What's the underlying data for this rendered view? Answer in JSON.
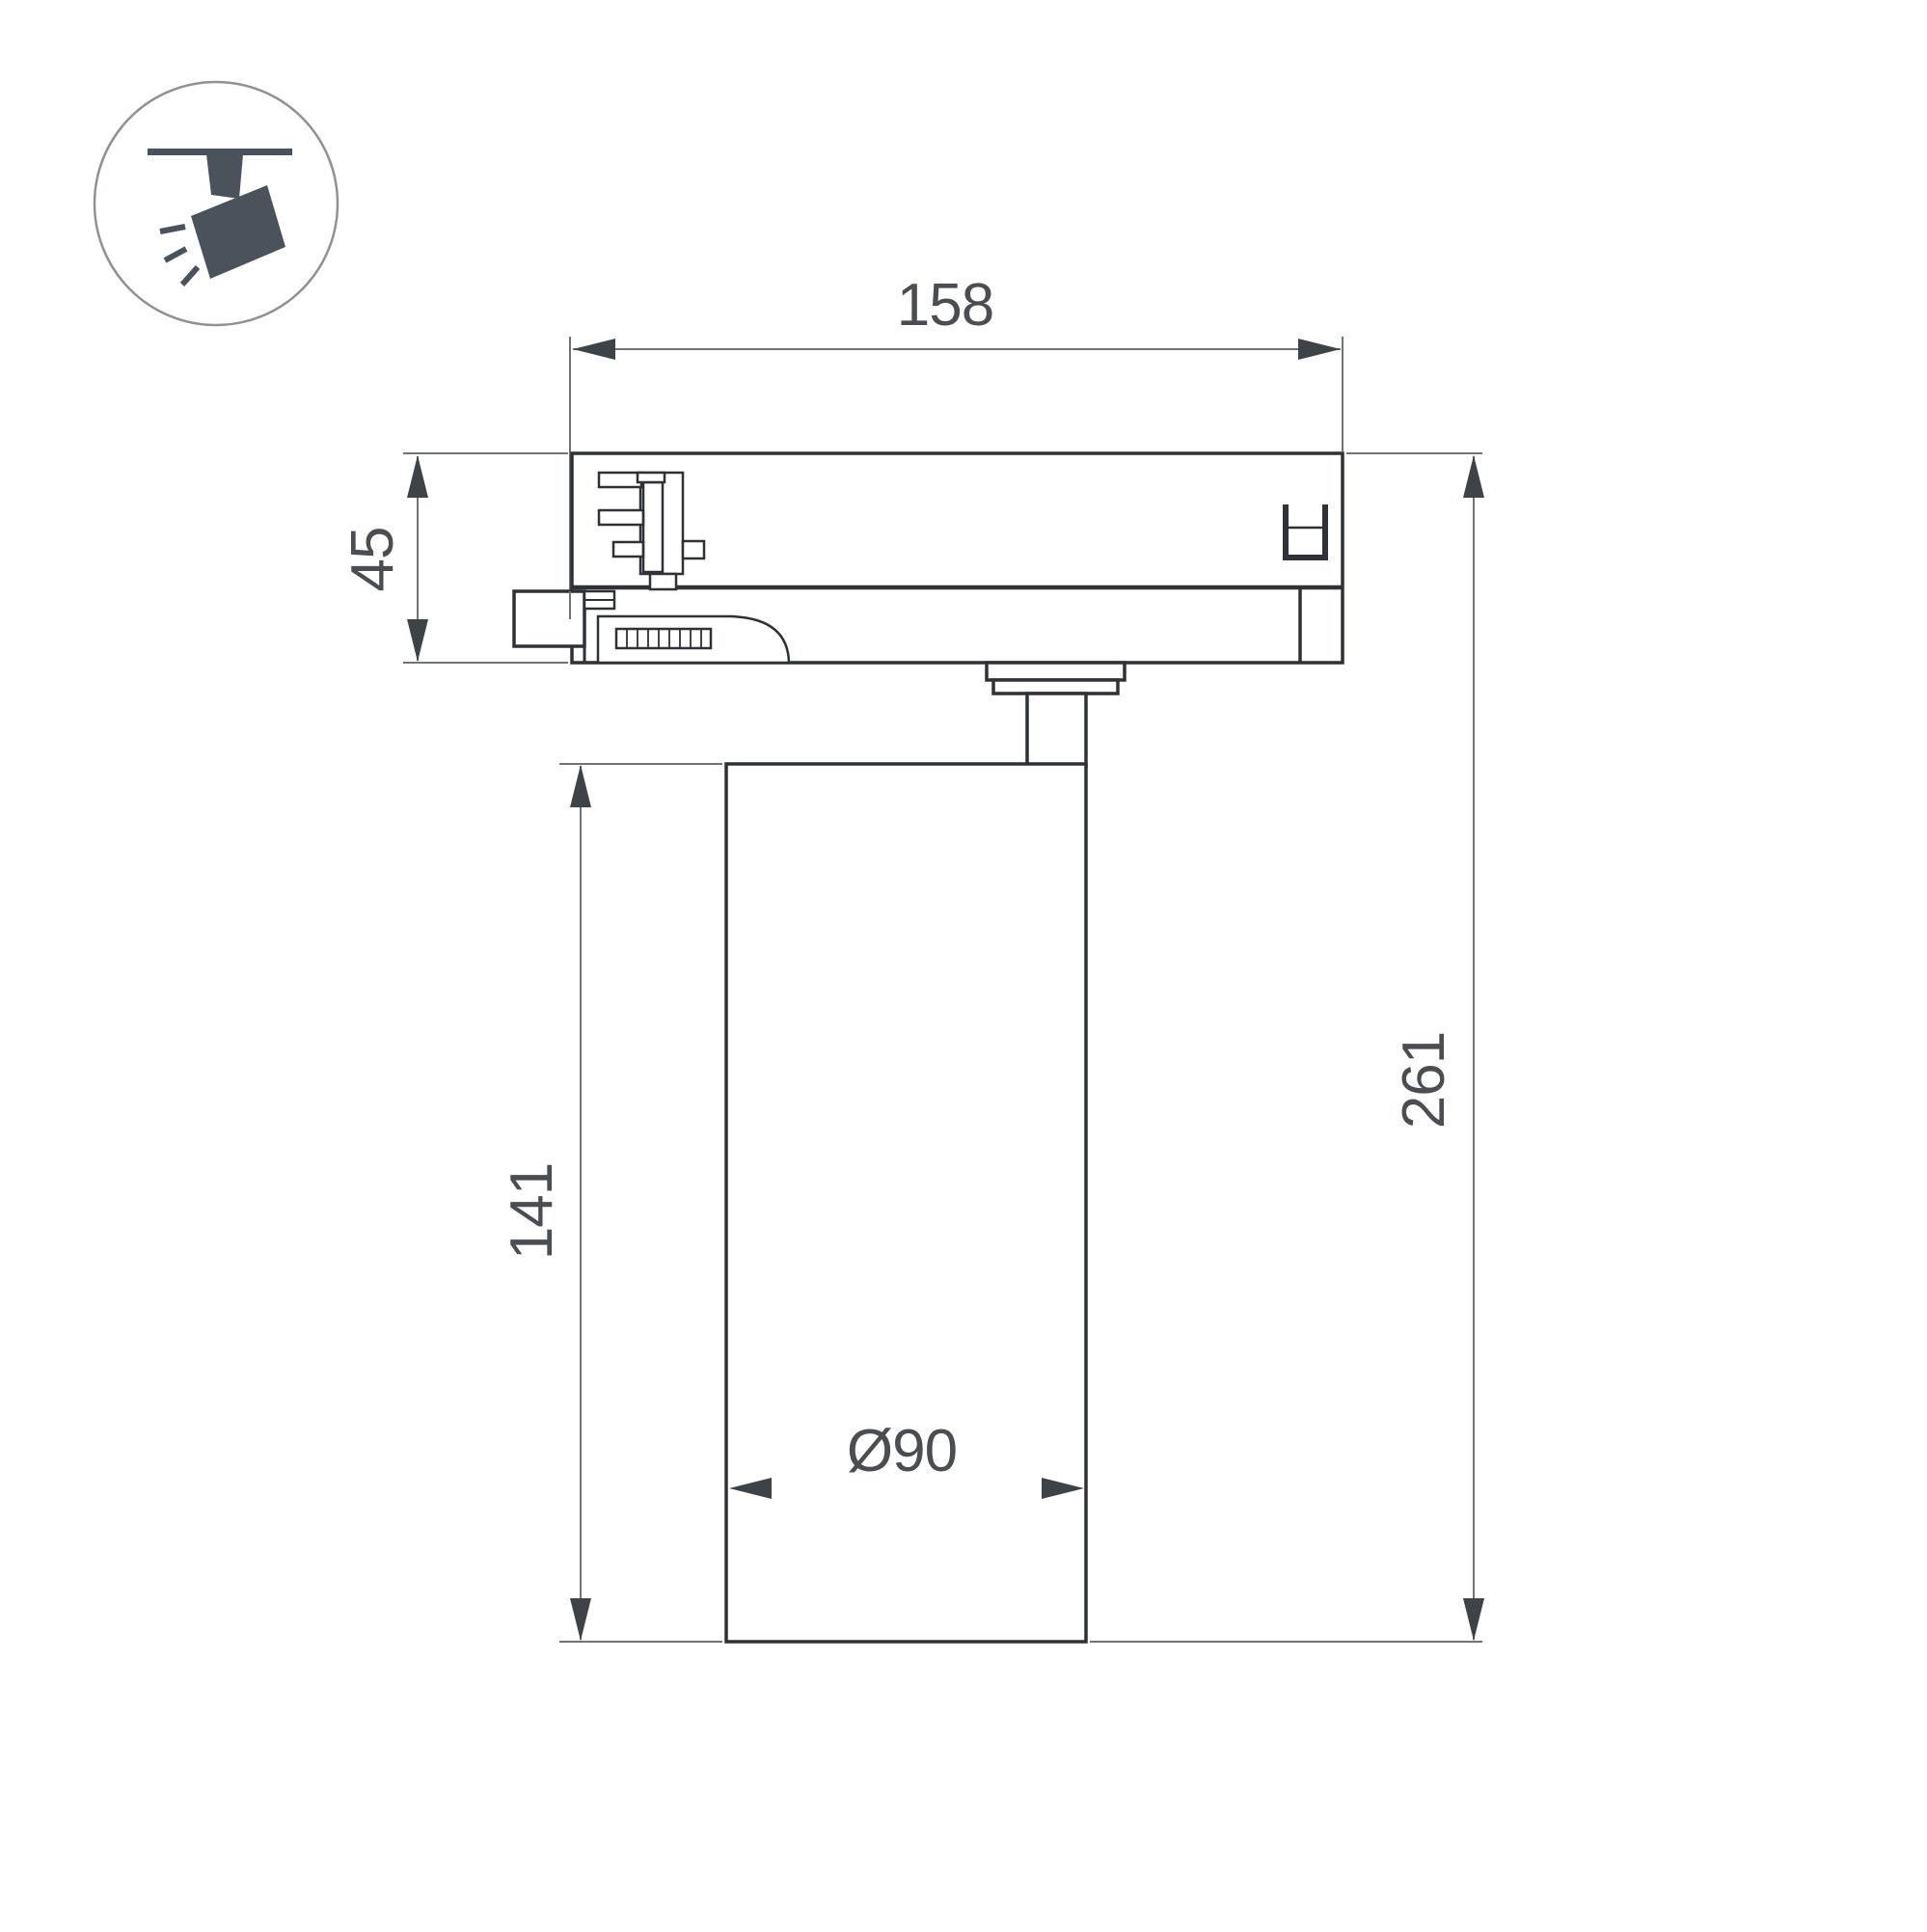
{
  "page": {
    "background": "#ffffff"
  },
  "icon": {
    "name": "track-spotlight-icon"
  },
  "dimensions": {
    "track_length": "158",
    "adapter_height": "45",
    "body_length": "141",
    "total_height": "261",
    "body_diameter": "Ø90"
  },
  "colors": {
    "outline": "#2e3237",
    "dimension_lines": "#717477",
    "arrowheads": "#3e4348",
    "dimension_text": "#4a4e53",
    "icon_pictogram": "#4a525b",
    "icon_circle_stroke": "#8f9194",
    "background": "#ffffff"
  }
}
